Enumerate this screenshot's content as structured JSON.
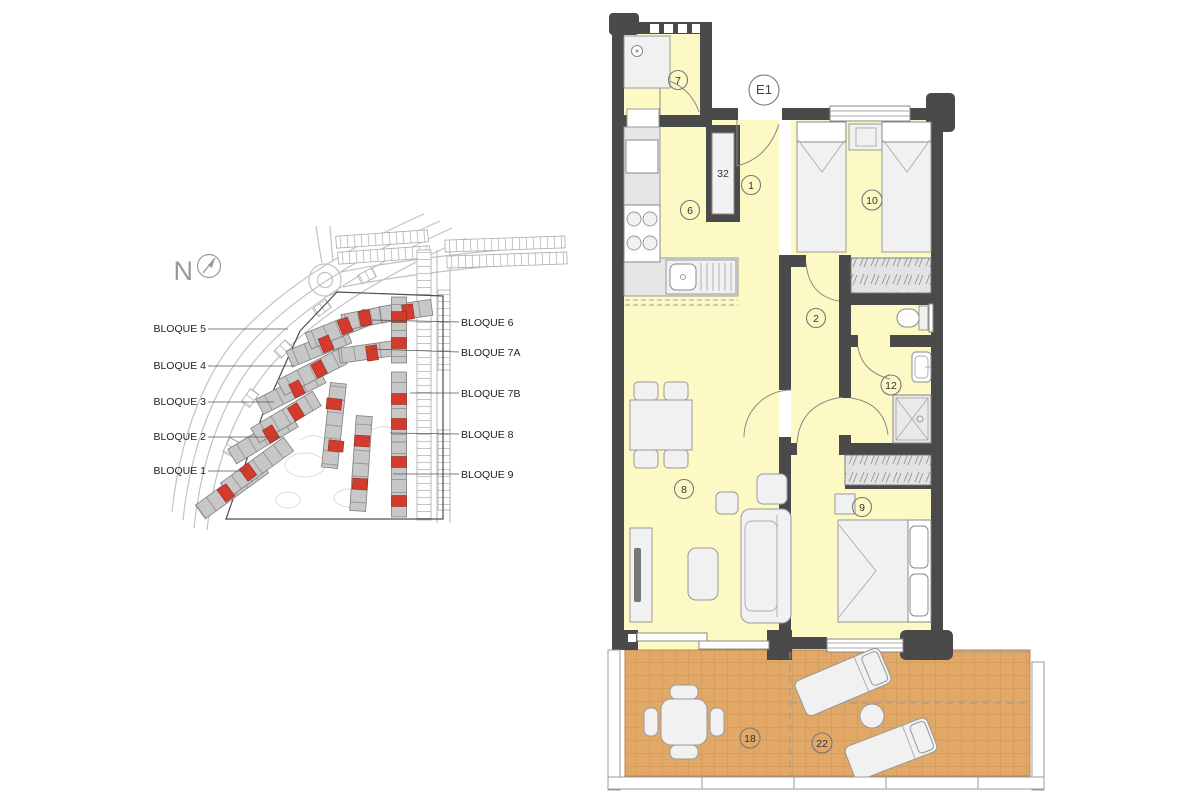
{
  "site_plan": {
    "north_label": "N",
    "labels_left": [
      "BLOQUE 5",
      "BLOQUE 4",
      "BLOQUE 3",
      "BLOQUE 2",
      "BLOQUE 1"
    ],
    "labels_right": [
      "BLOQUE 6",
      "BLOQUE 7A",
      "BLOQUE 7B",
      "BLOQUE 8",
      "BLOQUE 9"
    ],
    "colors": {
      "building": "#C7C7C7",
      "highlight_unit": "#D23B2E",
      "road": "#C2C2C2",
      "boundary": "#4E4E4E"
    }
  },
  "floor_plan": {
    "unit_label": "E1",
    "rooms": [
      {
        "id": "utility",
        "number": "7"
      },
      {
        "id": "entrance",
        "number": "1"
      },
      {
        "id": "kitchen",
        "number": "6"
      },
      {
        "id": "hall",
        "number": "2"
      },
      {
        "id": "living-dining",
        "number": "8"
      },
      {
        "id": "bedroom-2",
        "number": "10"
      },
      {
        "id": "bathroom",
        "number": "12"
      },
      {
        "id": "bedroom-1",
        "number": "9"
      },
      {
        "id": "terrace-dining",
        "number": "18"
      },
      {
        "id": "terrace-lounge",
        "number": "22"
      },
      {
        "id": "duct",
        "number": "32"
      }
    ],
    "colors": {
      "wall": "#4A4A4A",
      "floor": "#FCF9C4",
      "terrace": "#E2A867",
      "terrace_grid": "#C9924F"
    }
  }
}
